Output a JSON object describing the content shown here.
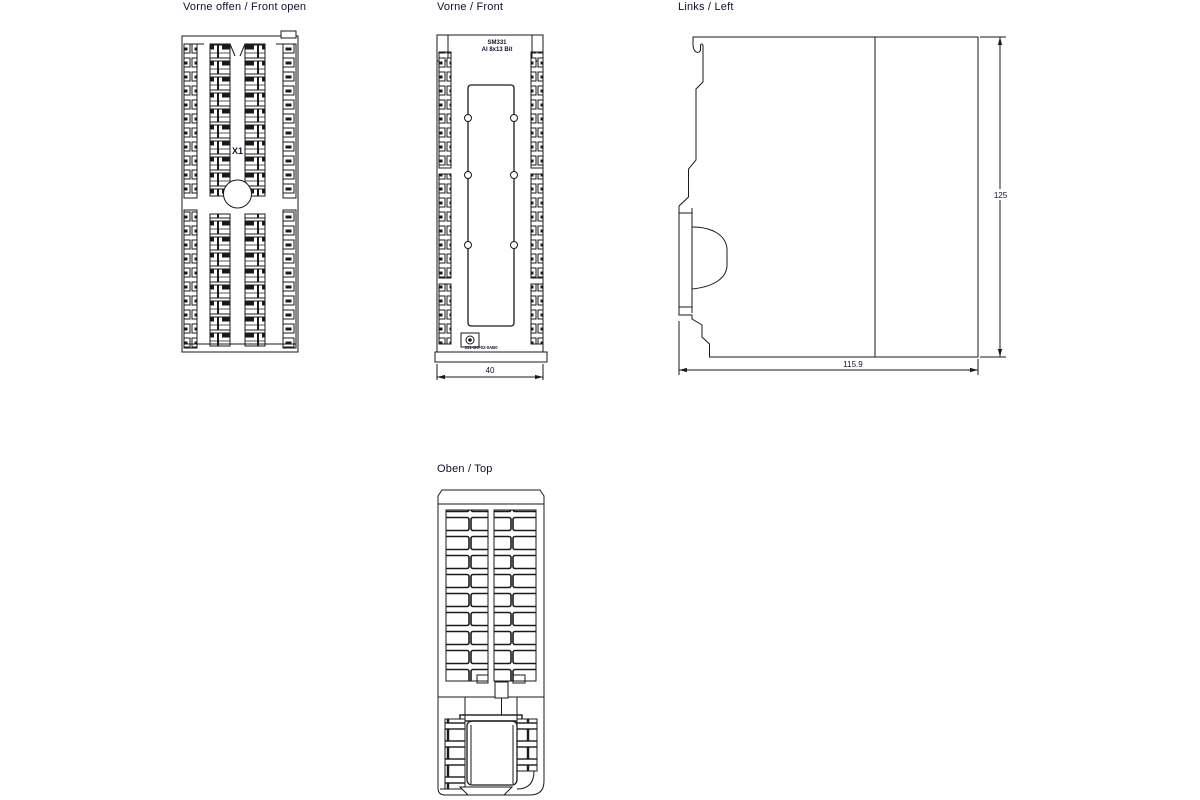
{
  "colors": {
    "background": "#ffffff",
    "line": "#1a1a1a",
    "text": "#10102e"
  },
  "views": {
    "front_open": {
      "label": "Vorne offen / Front open",
      "connector_label": "X1"
    },
    "front": {
      "label": "Vorne / Front",
      "module_line1": "SM331",
      "module_line2": "AI 8x13 Bit",
      "order_number": "331-1KF02-0AB0",
      "width_dim": "40"
    },
    "left": {
      "label": "Links / Left",
      "height_dim": "125",
      "depth_dim": "115.9"
    },
    "top": {
      "label": "Oben / Top"
    }
  }
}
